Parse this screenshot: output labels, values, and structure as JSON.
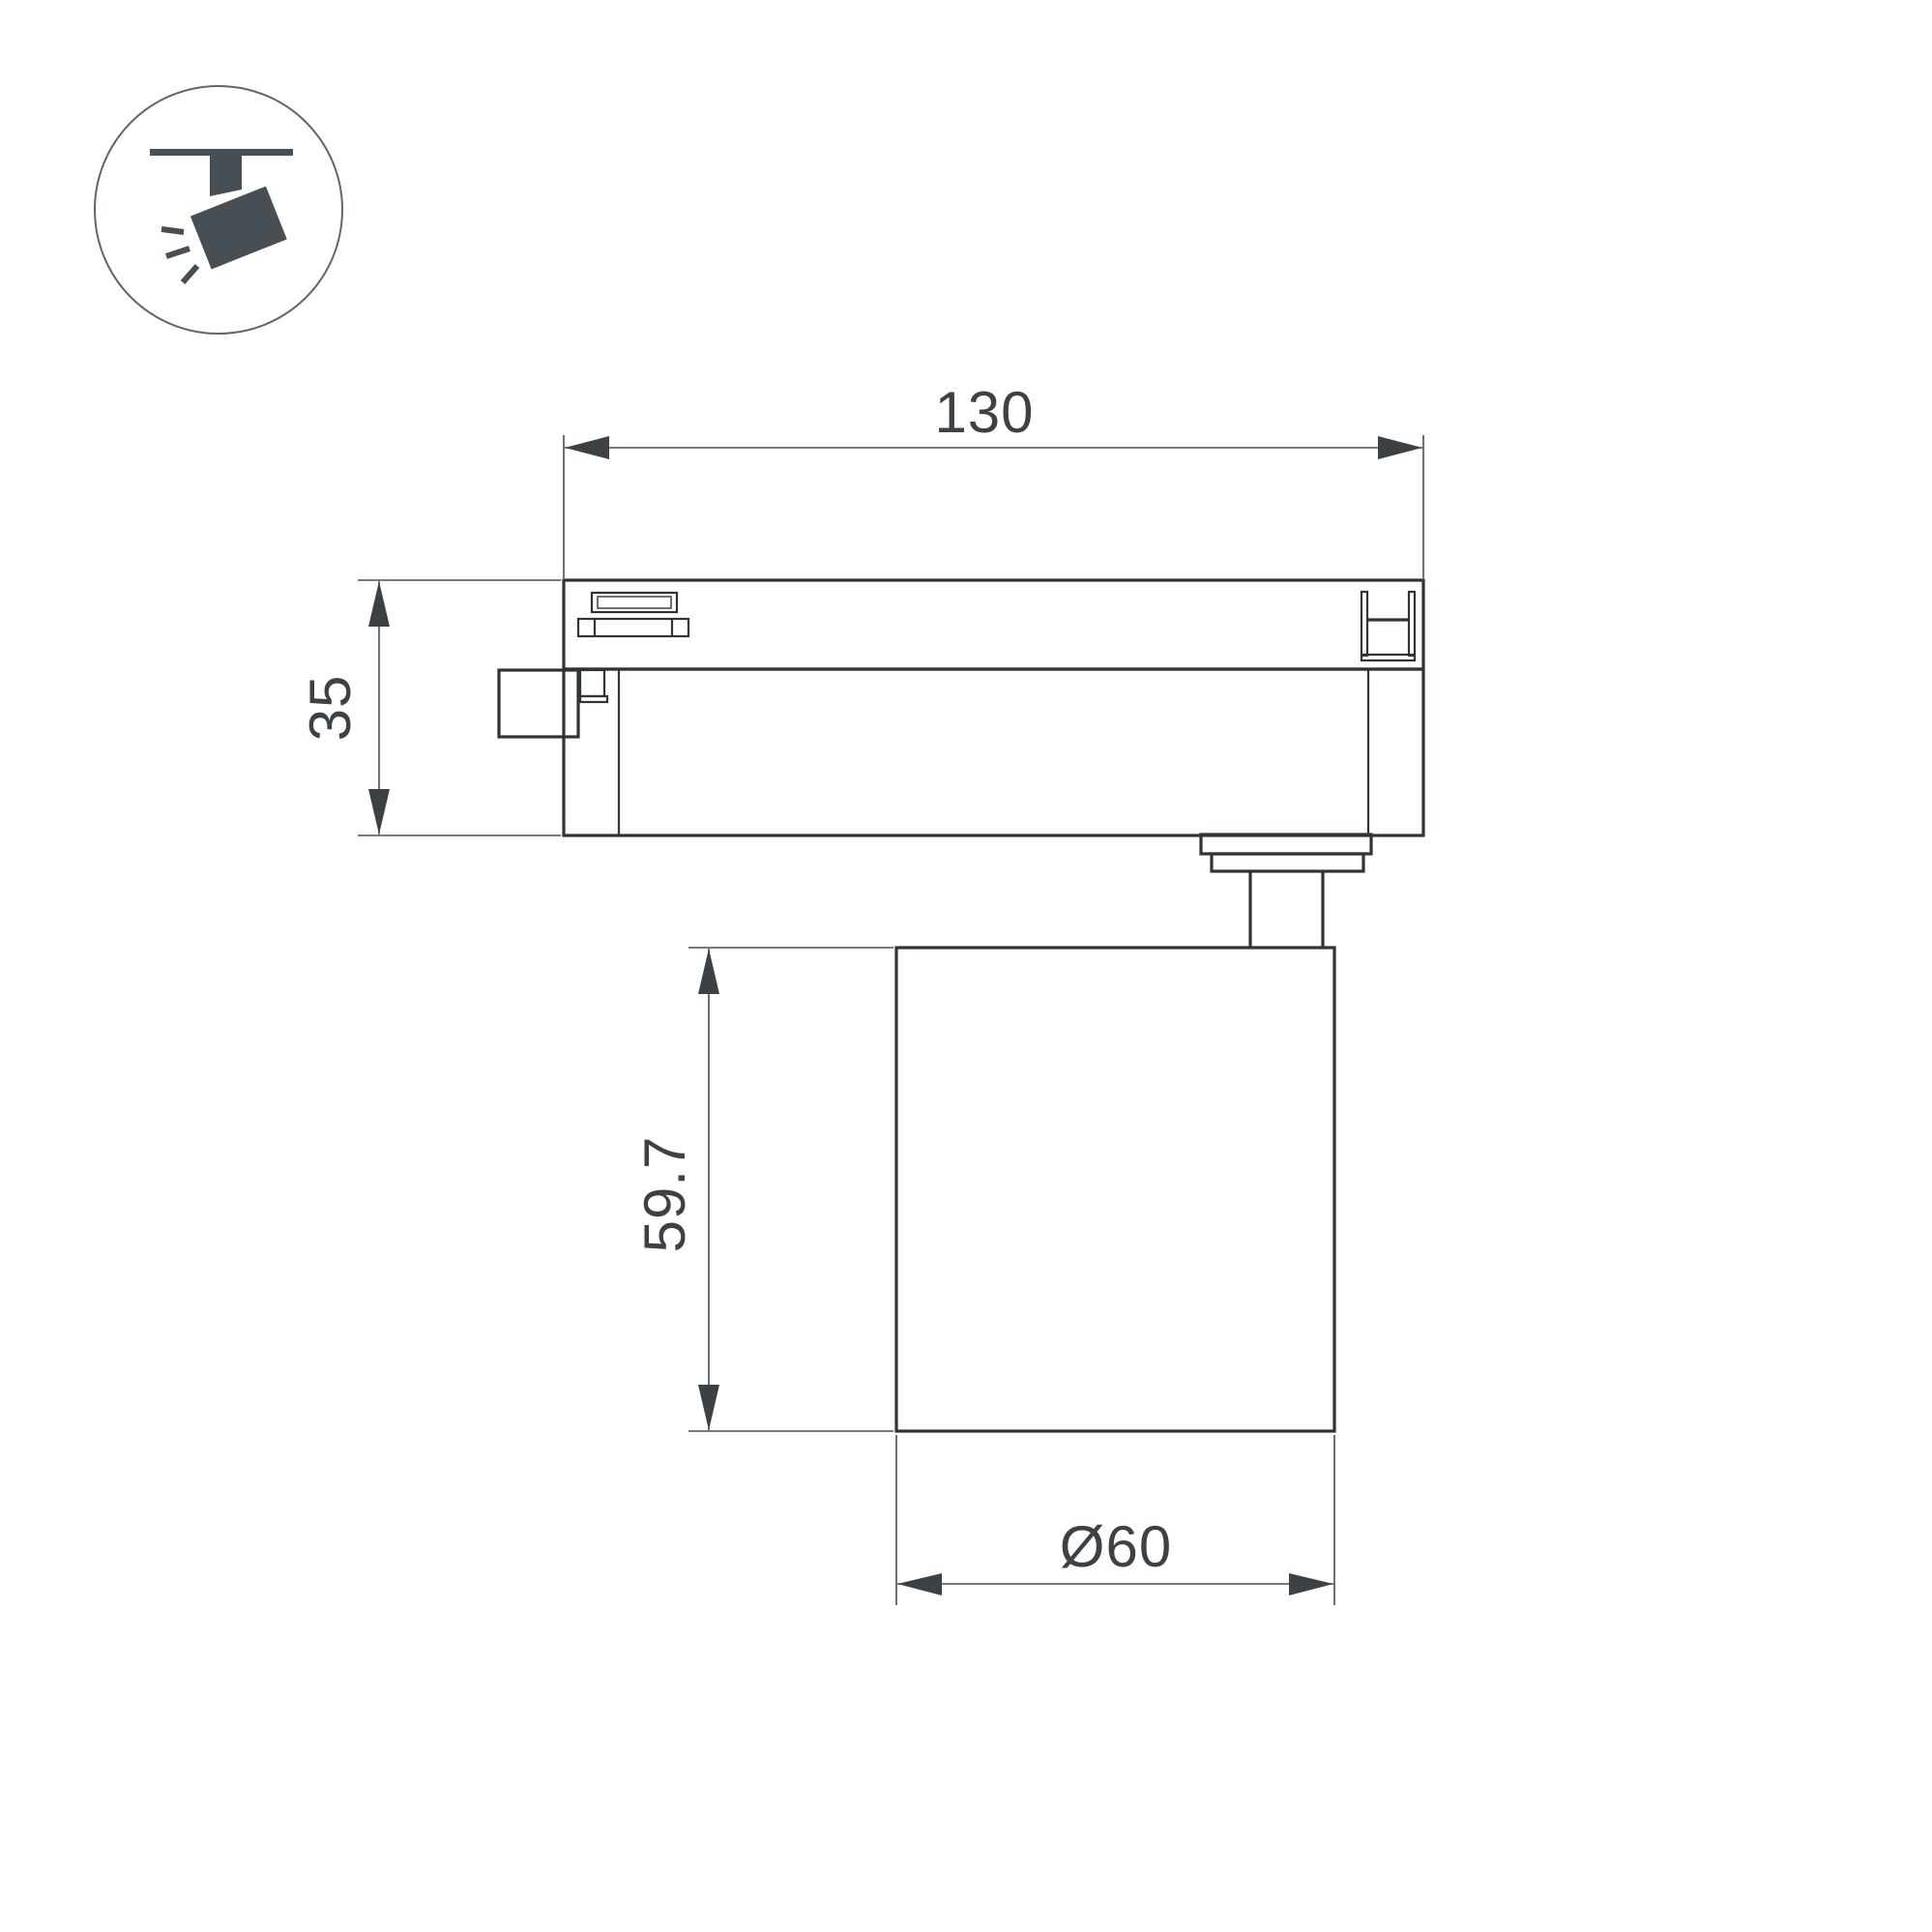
{
  "icon": {
    "name": "track-spotlight-pictogram"
  },
  "dimensions": {
    "adapter_length": {
      "label": "130"
    },
    "adapter_height": {
      "label": "35"
    },
    "body_height": {
      "label": "59.7"
    },
    "body_diameter": {
      "label": "Ø60"
    }
  },
  "colors": {
    "outline": "#2f3439",
    "thin_line": "#494e53",
    "text": "#3c4146",
    "icon": "#474e54",
    "background": "#ffffff"
  }
}
